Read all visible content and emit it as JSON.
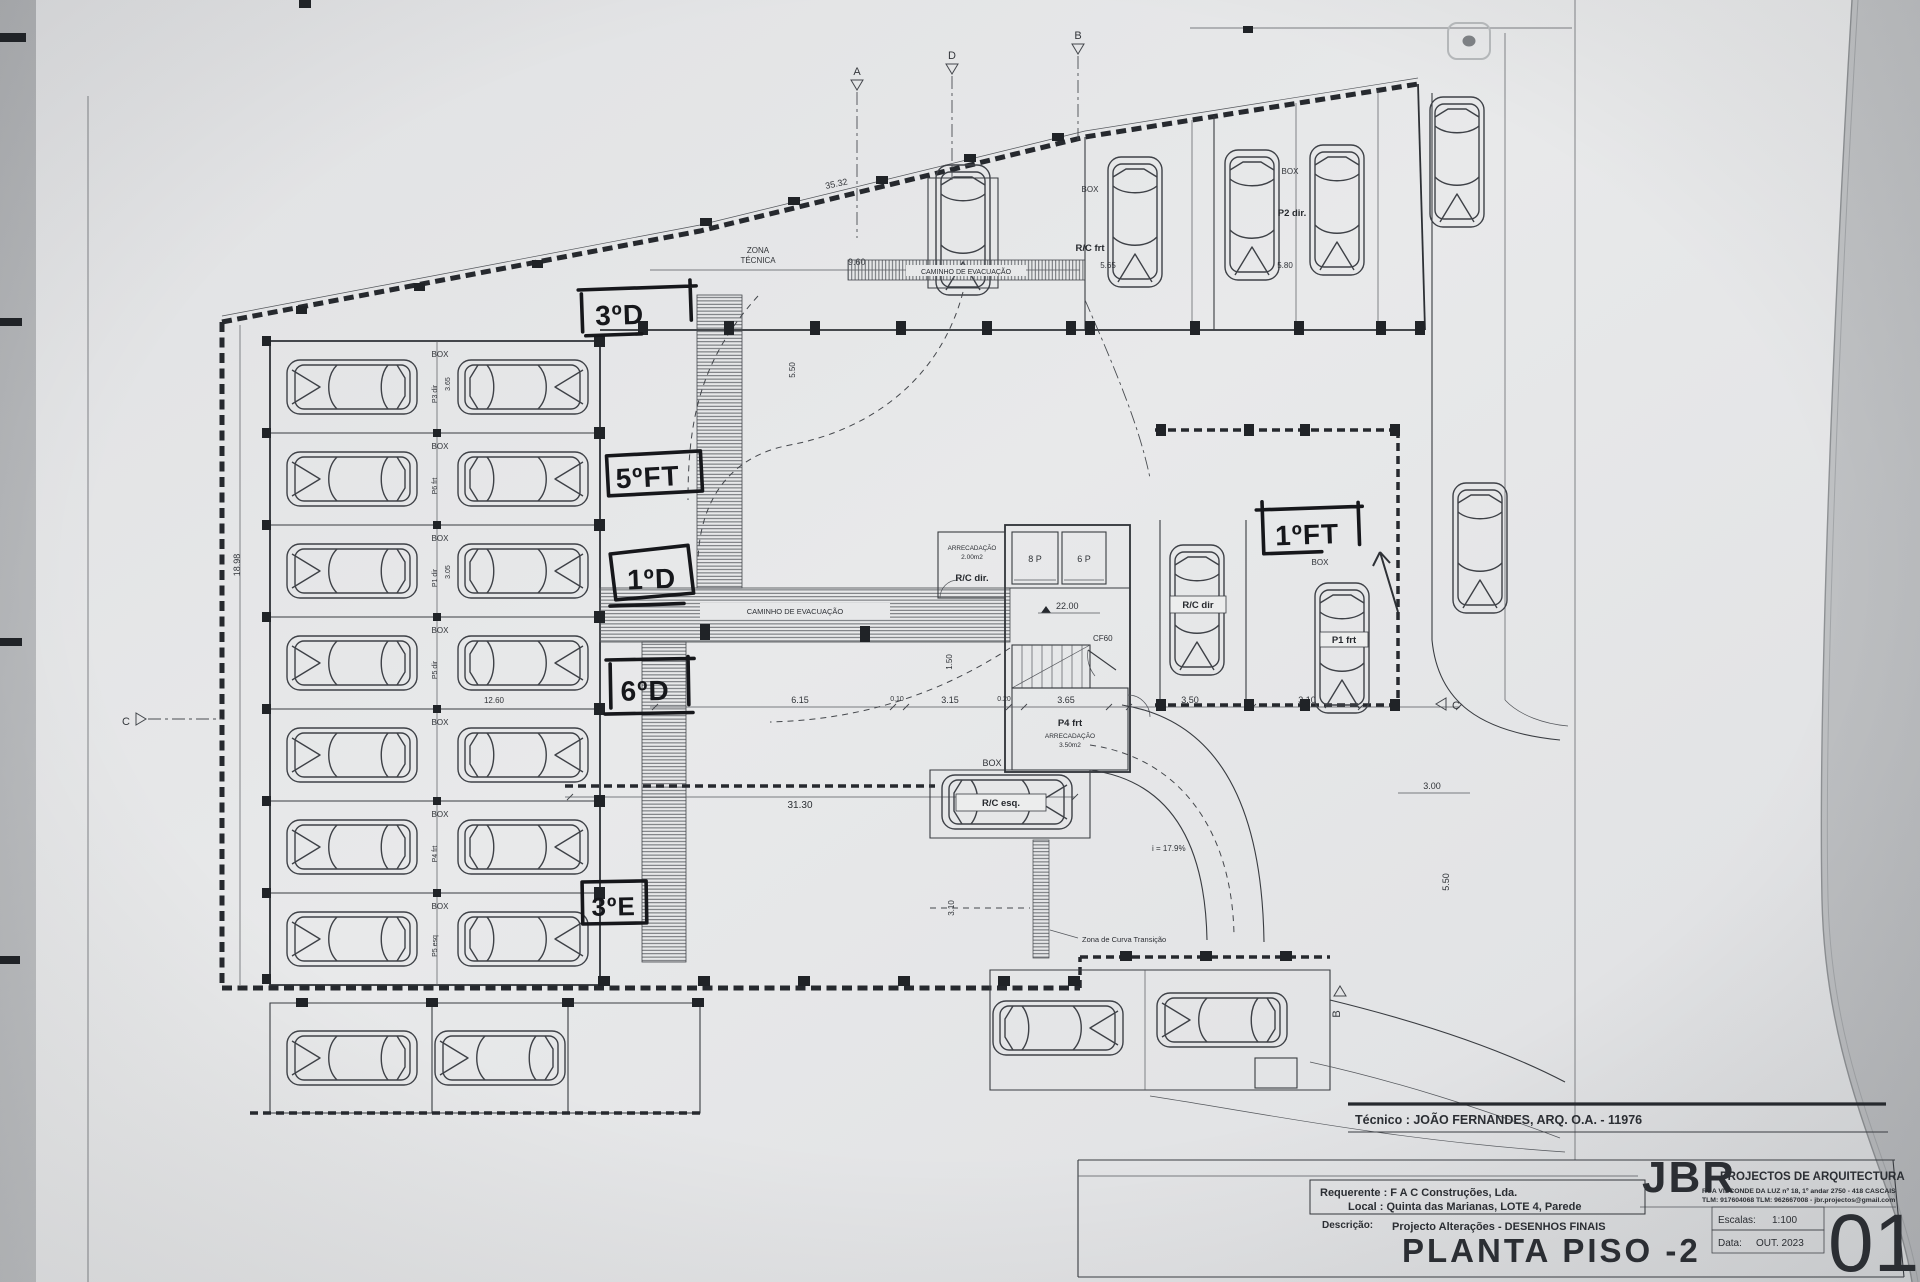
{
  "sheet": {
    "tecnico": "Técnico : JOÃO FERNANDES, ARQ.   O.A. - 11976",
    "logo": "JBR",
    "logo_sub": "PROJECTOS DE ARQUITECTURA",
    "address": "RUA VISCONDE DA LUZ nº 18, 1º andar   2750 - 418   CASCAIS",
    "contact": "TLM: 917604068  TLM: 962667008  -  jbr.projectos@gmail.com",
    "requerente": "Requerente : F A C  Construções, Lda.",
    "local": "Local : Quinta das Marianas, LOTE 4, Parede",
    "descricao_label": "Descrição:",
    "descricao": "Projecto Alterações - DESENHOS FINAIS",
    "title": "PLANTA PISO -2",
    "escalas_label": "Escalas:",
    "escalas": "1:100",
    "data_label": "Data:",
    "data": "OUT. 2023",
    "number": "01"
  },
  "plan": {
    "labels": {
      "box": "BOX",
      "zona1": "ZONA",
      "zona2": "TÉCNICA",
      "caminho": "CAMINHO DE EVACUAÇÃO",
      "curva": "Zona de Curva Transição",
      "rc_frt": "R/C frt",
      "p2_dir": "P2 dir.",
      "rc_dir": "R/C dir",
      "rc_dir_room": "R/C dir.",
      "rc_esq": "R/C esq.",
      "p1_frt": "P1 frt",
      "p4_frt": "P4 frt",
      "arrecadacao": "ARRECADAÇÃO",
      "area200": "2.00m2",
      "area350": "3.50m2",
      "elev8": "8 P",
      "elev6": "6 P",
      "cf60": "CF60",
      "slope": "i = 17.9%"
    },
    "rows": [
      "P3 dir",
      "P6 frt",
      "P1 dir",
      "P5 dir",
      "",
      "P4 frt",
      "P5 esq"
    ],
    "dims": {
      "top": "35.32",
      "zona": "9.60",
      "a": "5.65",
      "b": "5.80",
      "left": "18.98",
      "s1": "3.65",
      "s2": "3.05",
      "w": "12.60",
      "v550": "5.50",
      "r615": "6.15",
      "r010": "0.10",
      "r315": "3.15",
      "r020": "0.20",
      "r365": "3.65",
      "r350": "3.50",
      "r310": "3.10",
      "v150": "1.50",
      "level": "22.00",
      "d300": "3.00",
      "v550b": "5.50",
      "v310": "3.10",
      "w3130": "31.30"
    },
    "markers": {
      "a": "A",
      "b": "B",
      "c": "C",
      "d": "D"
    },
    "handwritten": [
      "3ºD",
      "5ºFT",
      "1ºD",
      "6ºD",
      "3ºE",
      "1ºFT"
    ]
  },
  "colors": {
    "ink": "#33363b",
    "paper": "#e6e7e8",
    "marker_ink": "#16171b"
  }
}
